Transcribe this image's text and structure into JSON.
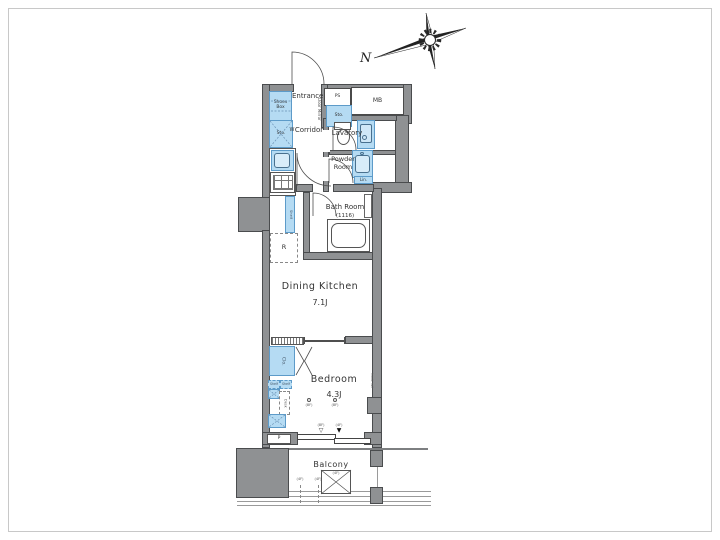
{
  "colors": {
    "wall": "#8f9193",
    "wall_dark": "#4a4c4e",
    "fixture_blue": "#b5dbf3",
    "fixture_blue_border": "#5d9bc9",
    "line": "#4f4f4f",
    "frame": "#c8c8c8",
    "text": "#333333"
  },
  "compass": {
    "north": "N"
  },
  "labels": {
    "shoes_box": "Shoes Box",
    "entrance": "Entrance",
    "door_mirror": "Door Mirror",
    "ps": "PS",
    "mb": "MB",
    "sto_upper": "Sto.",
    "sto_left": "Sto.",
    "washer": "W",
    "corridor": "Corridor",
    "lavatory": "Lavatory",
    "powder_line1": "Powder",
    "powder_line2": "Room",
    "linen": "Lin.",
    "bath_room": "Bath Room",
    "bath_size": "(1116)",
    "refrigerator": "R",
    "kitchen_shelf": "Shelf",
    "dining_kitchen": "Dining Kitchen",
    "dining_kitchen_size": "7.1J",
    "closet": "Clo.",
    "shelf_a": "Shelf",
    "shelf_b": "Shelf",
    "desk": "Desk",
    "bedroom": "Bedroom",
    "bedroom_size": "4.3J",
    "hook_rail": "hook rail",
    "pipe": "P",
    "balcony": "Balcony"
  },
  "marks": {
    "ceiling_a": "(8F)",
    "ceiling_b": "(8F)",
    "tri_open_label": "(8F)",
    "tri_open": "▽",
    "tri_filled_label": "(4F)",
    "tri_filled": "▼",
    "balcony_a": "(4F)",
    "balcony_b": "(4F)",
    "hatch": "(4F)"
  }
}
